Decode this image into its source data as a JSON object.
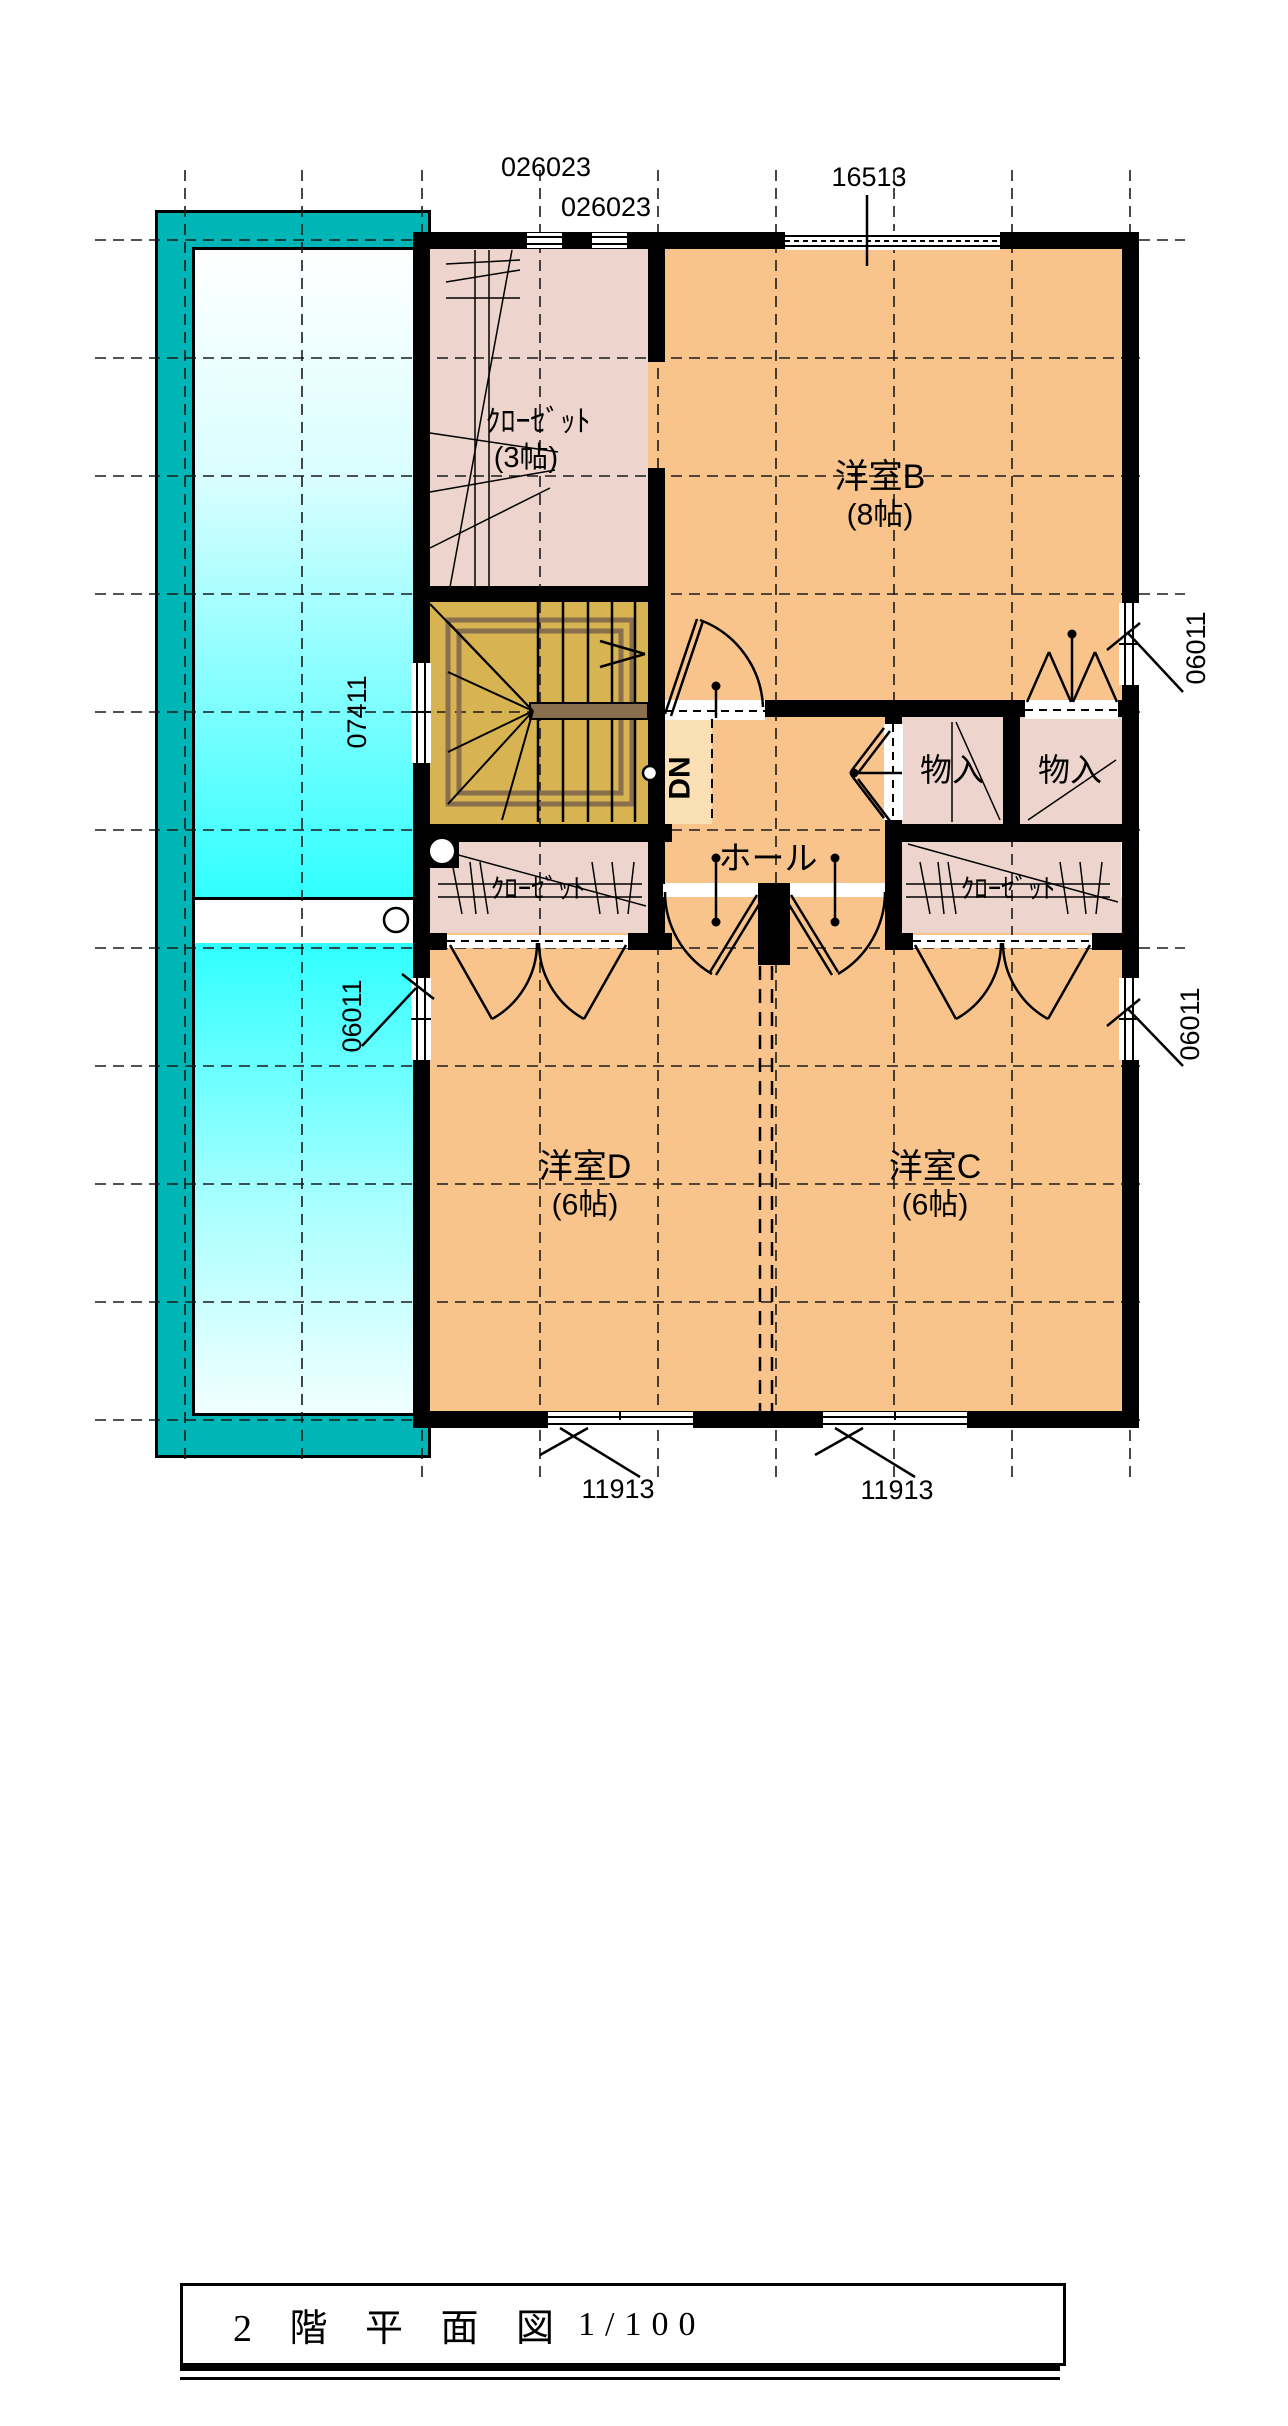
{
  "title_block": {
    "title": "2 階 平 面 図",
    "scale": "1/100"
  },
  "rooms": {
    "closet_b": {
      "name": "ｸﾛｰｾﾞｯﾄ",
      "size": "(3帖)"
    },
    "room_b": {
      "name": "洋室B",
      "size": "(8帖)"
    },
    "storage_left": {
      "name": "物入"
    },
    "storage_right": {
      "name": "物入"
    },
    "hall": {
      "name": "ホール"
    },
    "closet_d": {
      "name": "ｸﾛｰｾﾞｯﾄ"
    },
    "closet_c": {
      "name": "ｸﾛｰｾﾞｯﾄ"
    },
    "room_d": {
      "name": "洋室D",
      "size": "(6帖)"
    },
    "room_c": {
      "name": "洋室C",
      "size": "(6帖)"
    }
  },
  "stairs": {
    "down_label": "DN"
  },
  "dimensions": {
    "top_left_1": "026023",
    "top_left_2": "026023",
    "top_right": "16513",
    "left_balcony": "07411",
    "left_room_d": "06011",
    "right_room_b": "06011",
    "right_room_c": "06011",
    "bottom_left": "11913",
    "bottom_right": "11913"
  },
  "colors": {
    "room_floor": "#F8C48C",
    "closet_floor": "#EDD4CC",
    "stair_floor": "#D8B352",
    "stair_rail": "#8A6F4F",
    "dn_strip": "#FBE0B6",
    "balcony_band": "#00B5B5",
    "balcony_glass": "#30FFFF",
    "wall": "#000000"
  }
}
